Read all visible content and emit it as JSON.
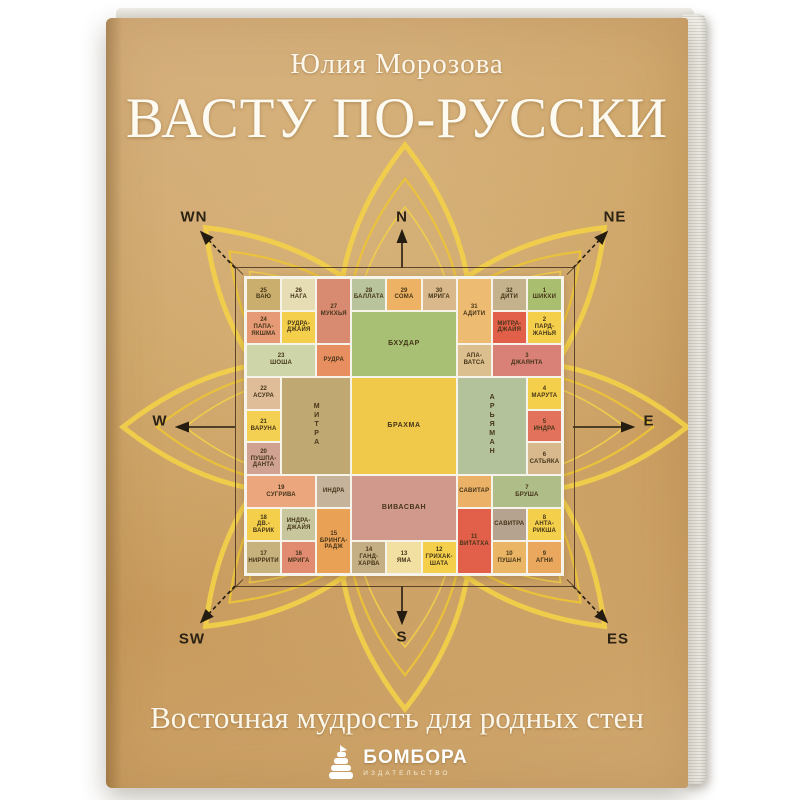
{
  "cover": {
    "author": "Юлия Морозова",
    "title": "ВАСТУ ПО-РУССКИ",
    "subtitle": "Восточная мудрость для родных стен",
    "publisher": {
      "name": "БОМБОРА",
      "tagline": "ИЗДАТЕЛЬСТВО",
      "icon": "cairn-stones-icon"
    },
    "colors": {
      "paper": "#cda467",
      "text": "#fbf6ea",
      "lotus": "#f3d049",
      "grid_lines": "#f6f3ea",
      "frame": "#46341c"
    }
  },
  "compass": {
    "n": "N",
    "s": "S",
    "w": "W",
    "e": "E",
    "wn": "WN",
    "ne": "NE",
    "sw": "SW",
    "es": "ES"
  },
  "grid": {
    "cells": [
      {
        "n": "25",
        "t": "ВАЮ",
        "c": 1,
        "r": 1,
        "bg": "#c9ae6d"
      },
      {
        "n": "26",
        "t": "НАГА",
        "c": 2,
        "r": 1,
        "bg": "#e6ddb4"
      },
      {
        "n": "27",
        "t": "МУКХЬЯ",
        "c": 3,
        "r": 1,
        "rs": 2,
        "bg": "#d98b72"
      },
      {
        "n": "28",
        "t": "БАЛЛАТА",
        "c": 4,
        "r": 1,
        "bg": "#b9c49c"
      },
      {
        "n": "29",
        "t": "СОМА",
        "c": 5,
        "r": 1,
        "bg": "#eeb264"
      },
      {
        "n": "30",
        "t": "МРИГА",
        "c": 6,
        "r": 1,
        "bg": "#d9b98b"
      },
      {
        "n": "31",
        "t": "АДИТИ",
        "c": 7,
        "r": 1,
        "rs": 2,
        "bg": "#eebb72"
      },
      {
        "n": "32",
        "t": "ДИТИ",
        "c": 8,
        "r": 1,
        "bg": "#c3b28c"
      },
      {
        "n": "1",
        "t": "ШИКХИ",
        "c": 9,
        "r": 1,
        "bg": "#aabe70"
      },
      {
        "n": "24",
        "t": "ПАПА-ЯКШМА",
        "c": 1,
        "r": 2,
        "bg": "#e69b76"
      },
      {
        "t": "РУДРА-ДЖАЙЯ",
        "c": 2,
        "r": 2,
        "bg": "#f3cf4c"
      },
      {
        "t": "БХУДАР",
        "c": 4,
        "r": 2,
        "cs": 3,
        "rs": 2,
        "bg": "#a7c073",
        "big": 1
      },
      {
        "t": "МИТРА-ДЖАЙЯ",
        "c": 8,
        "r": 2,
        "bg": "#e2604a"
      },
      {
        "n": "2",
        "t": "ПАРД-ЖАНЬЯ",
        "c": 9,
        "r": 2,
        "bg": "#f3cf4c"
      },
      {
        "n": "23",
        "t": "ШОША",
        "c": 1,
        "r": 3,
        "cs": 2,
        "bg": "#cdd5a9"
      },
      {
        "t": "РУДРА",
        "c": 3,
        "r": 3,
        "bg": "#e88f61"
      },
      {
        "t": "АПА-ВАТСА",
        "c": 7,
        "r": 3,
        "bg": "#dcbf8f"
      },
      {
        "n": "3",
        "t": "ДЖАЯНТА",
        "c": 8,
        "r": 3,
        "cs": 2,
        "bg": "#d98077"
      },
      {
        "n": "22",
        "t": "АСУРА",
        "c": 1,
        "r": 4,
        "bg": "#dfbd99"
      },
      {
        "t": "МИТРА",
        "c": 2,
        "r": 4,
        "cs": 2,
        "rs": 3,
        "bg": "#c0a872",
        "big": 1,
        "v": 1
      },
      {
        "t": "БРАХМА",
        "c": 4,
        "r": 4,
        "cs": 3,
        "rs": 3,
        "bg": "#f0c94a",
        "big": 1
      },
      {
        "t": "АРЬЯМАН",
        "c": 7,
        "r": 4,
        "cs": 2,
        "rs": 3,
        "bg": "#b3c29b",
        "big": 1,
        "v": 1
      },
      {
        "n": "4",
        "t": "МАРУТА",
        "c": 9,
        "r": 4,
        "bg": "#f3cf4c"
      },
      {
        "n": "21",
        "t": "ВАРУНА",
        "c": 1,
        "r": 5,
        "bg": "#f4d052"
      },
      {
        "n": "5",
        "t": "ИНДРА",
        "c": 9,
        "r": 5,
        "bg": "#e2725b"
      },
      {
        "n": "20",
        "t": "ПУШПА-ДАНТА",
        "c": 1,
        "r": 6,
        "bg": "#d0a292"
      },
      {
        "n": "6",
        "t": "САТЬЯКА",
        "c": 9,
        "r": 6,
        "bg": "#d7b98d"
      },
      {
        "n": "19",
        "t": "СУГРИВА",
        "c": 1,
        "r": 7,
        "cs": 2,
        "bg": "#eba67e"
      },
      {
        "t": "ИНДРА",
        "c": 3,
        "r": 7,
        "bg": "#c5b49b"
      },
      {
        "t": "ВИВАСВАН",
        "c": 4,
        "r": 7,
        "cs": 3,
        "rs": 2,
        "bg": "#d1998b",
        "big": 1
      },
      {
        "t": "САВИТАР",
        "c": 7,
        "r": 7,
        "bg": "#ebb167"
      },
      {
        "n": "7",
        "t": "БРУША",
        "c": 8,
        "r": 7,
        "cs": 2,
        "bg": "#afbd88"
      },
      {
        "n": "18",
        "t": "ДВ.-ВАРИК",
        "c": 1,
        "r": 8,
        "bg": "#f3cf4c"
      },
      {
        "t": "ИНДРА-ДЖАЙЯ",
        "c": 2,
        "r": 8,
        "bg": "#c8c69d"
      },
      {
        "n": "15",
        "t": "БРИНГА-РАДЖ",
        "c": 3,
        "r": 8,
        "rs": 2,
        "bg": "#e9a156"
      },
      {
        "n": "11",
        "t": "ВИТАТХА",
        "c": 7,
        "r": 8,
        "rs": 2,
        "bg": "#e2604a"
      },
      {
        "t": "САВИТРА",
        "c": 8,
        "r": 8,
        "bg": "#b5a390"
      },
      {
        "n": "8",
        "t": "АНТА-РИКША",
        "c": 9,
        "r": 8,
        "bg": "#f3cf4c"
      },
      {
        "n": "17",
        "t": "НИРРИТИ",
        "c": 1,
        "r": 9,
        "bg": "#c7b17d"
      },
      {
        "n": "16",
        "t": "МРИГА",
        "c": 2,
        "r": 9,
        "bg": "#e18b71"
      },
      {
        "n": "14",
        "t": "ГАНД-ХАРВА",
        "c": 4,
        "r": 9,
        "bg": "#c4ae83"
      },
      {
        "n": "13",
        "t": "ЯМА",
        "c": 5,
        "r": 9,
        "bg": "#f1e0a1"
      },
      {
        "n": "12",
        "t": "ГРИХАК-ШАТА",
        "c": 6,
        "r": 9,
        "bg": "#f3cf4c"
      },
      {
        "n": "10",
        "t": "ПУШАН",
        "c": 8,
        "r": 9,
        "bg": "#ebb566"
      },
      {
        "n": "9",
        "t": "АГНИ",
        "c": 9,
        "r": 9,
        "bg": "#eaa85f"
      }
    ]
  }
}
